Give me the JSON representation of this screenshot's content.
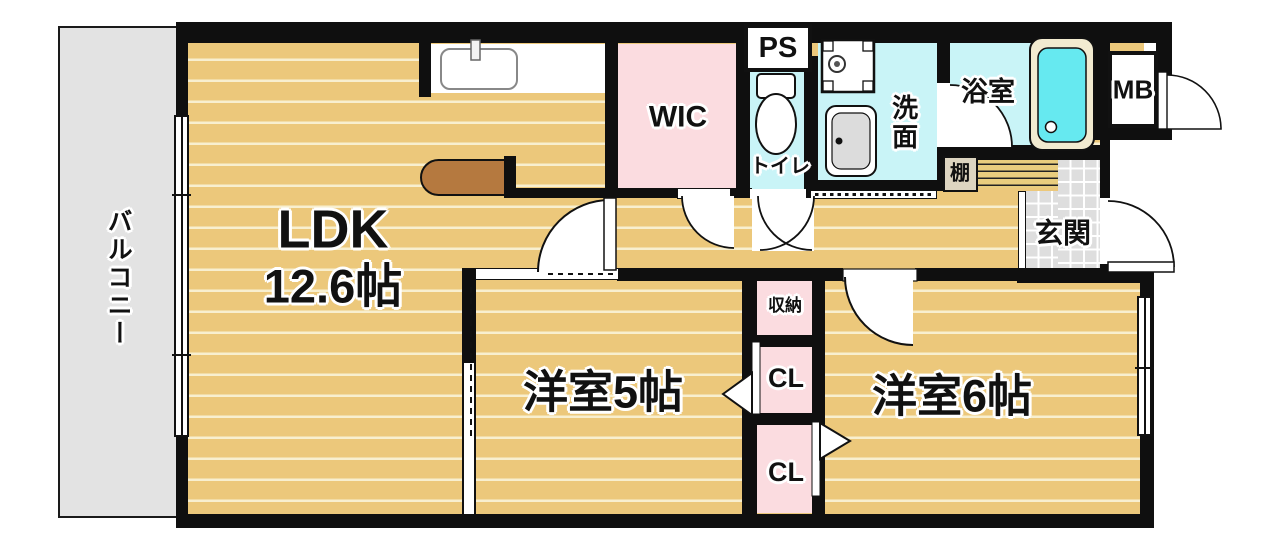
{
  "rooms": {
    "balcony": "バルコニー",
    "ldk": "LDK",
    "ldk_size": "12.6帖",
    "wic": "WIC",
    "ps": "PS",
    "toilet": "トイレ",
    "washroom": "洗面",
    "bathroom": "浴室",
    "meter_box": "MB",
    "shelf": "棚",
    "entrance": "玄関",
    "storage": "収納",
    "closet_upper": "CL",
    "closet_lower": "CL",
    "bedroom5": "洋室5帖",
    "bedroom6": "洋室6帖"
  },
  "colors": {
    "wood_floor": "#ecc87b",
    "wood_stripe": "#f8efcf",
    "wet_area": "#c9f4f7",
    "closet_pink": "#fbdce0",
    "balcony_gray": "#e3e3e3",
    "tile_gray": "#dedede",
    "tub_cyan": "#66e9f0",
    "tub_rim": "#f2ebd0",
    "counter_brown": "#b5793f",
    "wall_black": "#0f0f0f"
  }
}
